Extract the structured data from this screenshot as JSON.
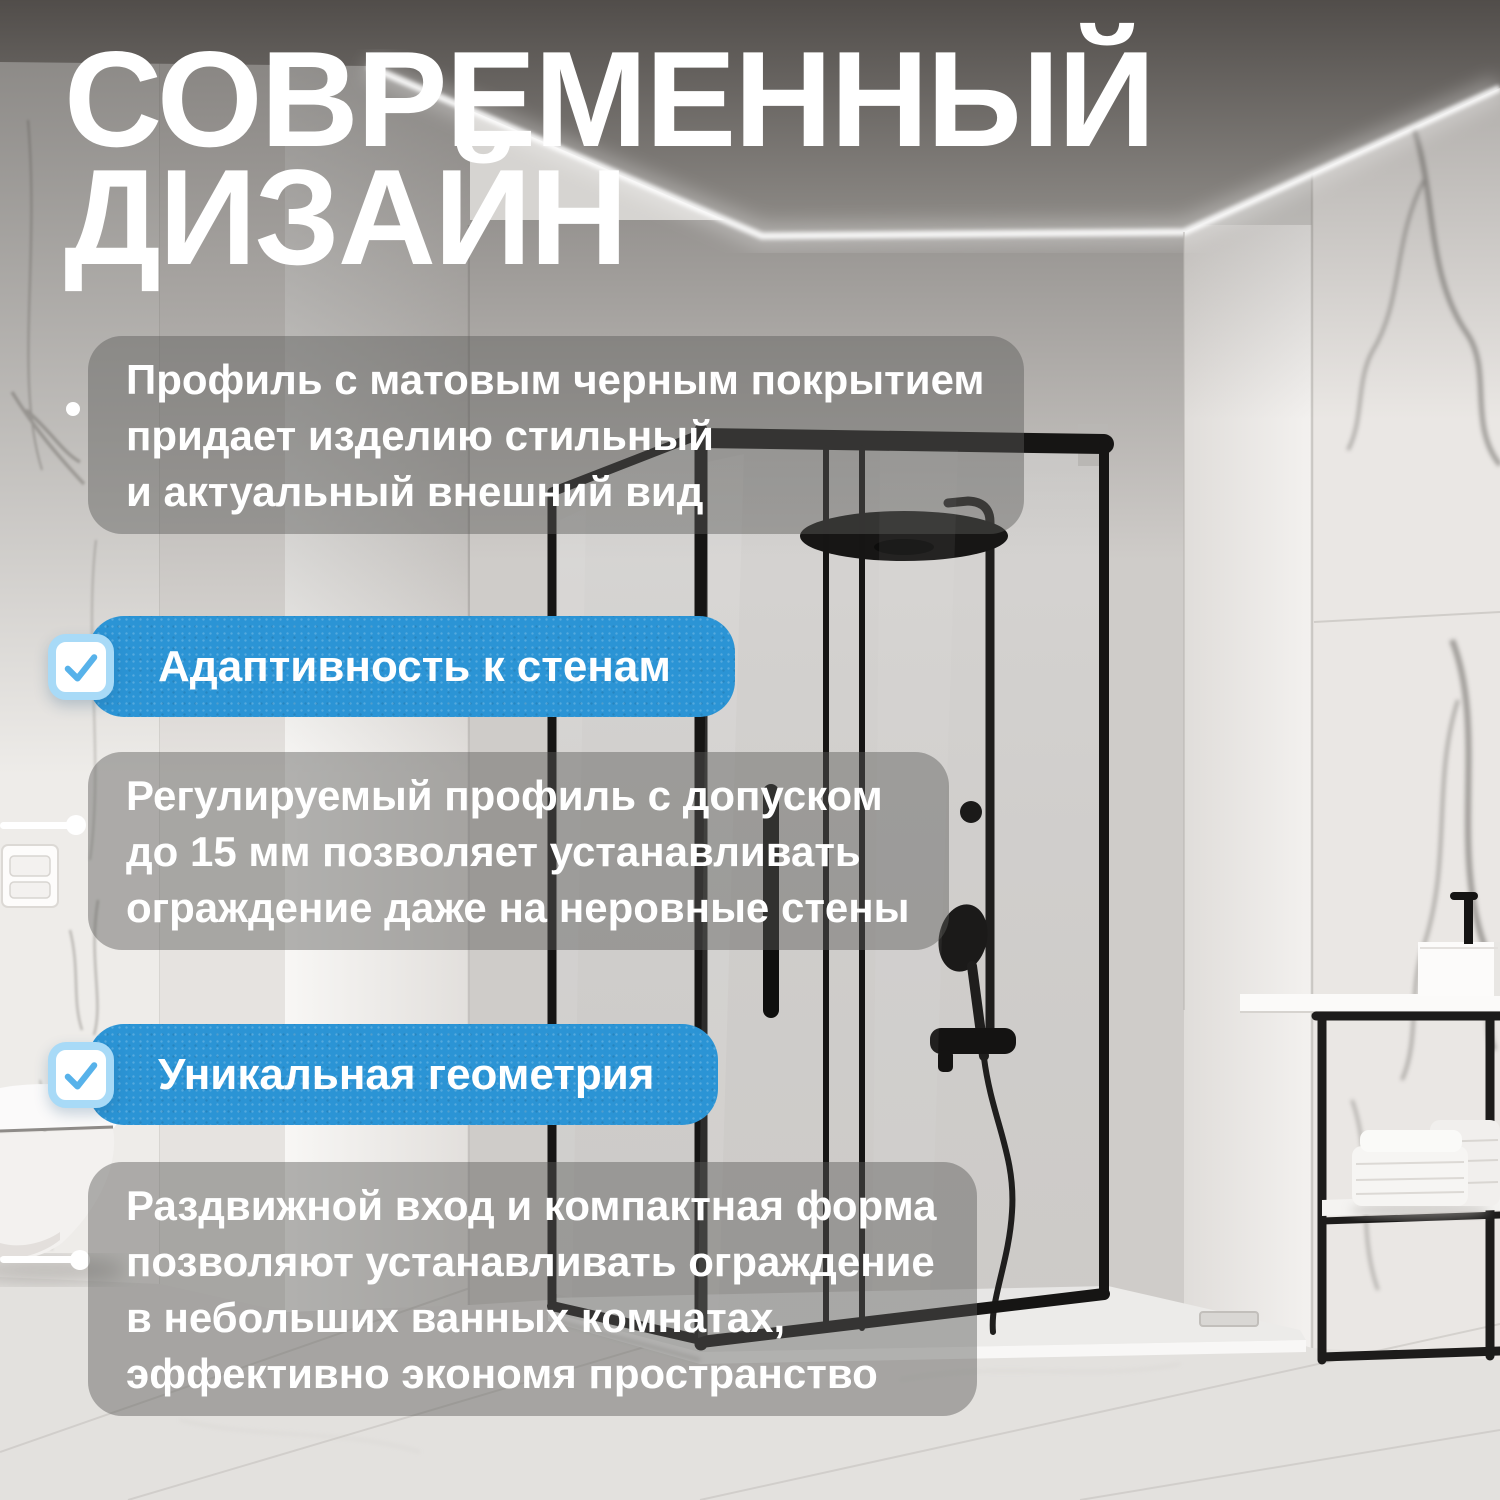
{
  "title": {
    "line1": "СОВРЕМЕННЫЙ",
    "line2": "ДИЗАЙН"
  },
  "intro": {
    "lines": [
      "Профиль с матовым черным покрытием",
      "придает изделию стильный",
      "и актуальный внешний вид"
    ]
  },
  "features": [
    {
      "label": "Адаптивность к стенам",
      "description_lines": [
        "Регулируемый профиль с допуском",
        "до 15 мм позволяет устанавливать",
        "ограждение даже на неровные стены"
      ]
    },
    {
      "label": "Уникальная геометрия",
      "description_lines": [
        "Раздвижной вход и компактная форма",
        "позволяют устанавливать ограждение",
        "в небольших ванных комнатах,",
        "эффективно экономя пространство"
      ]
    }
  ],
  "colors": {
    "accent_blue": "#2B94D5",
    "checkbox_border": "#A8DAF7",
    "checkmark_blue": "#57B2EA",
    "overlay_gray": "rgba(92,90,88,0.45)",
    "text": "#FFFFFF"
  },
  "icons": [
    {
      "name": "check-icon",
      "glyph": "✓"
    }
  ]
}
